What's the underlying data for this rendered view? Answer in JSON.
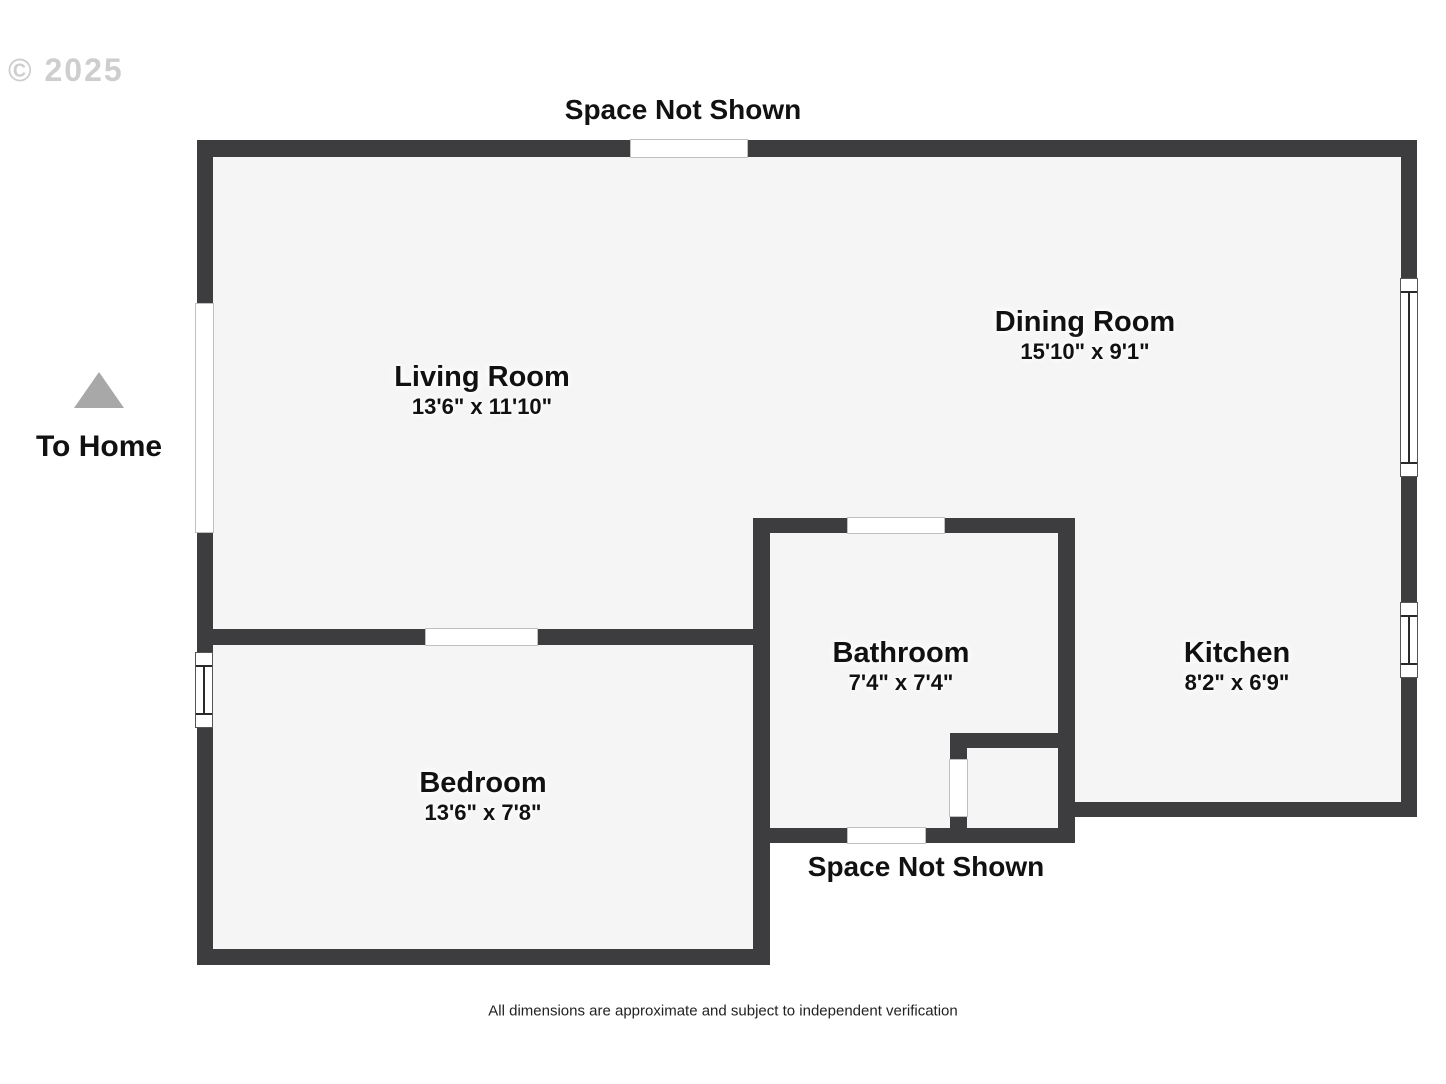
{
  "annotations": {
    "copyright": "© 2025",
    "space_not_shown_top": "Space Not Shown",
    "space_not_shown_bottom": "Space Not Shown",
    "to_home": "To Home",
    "footer": "All dimensions are approximate and subject to independent verification"
  },
  "rooms": [
    {
      "name": "Living Room",
      "dims": "13'6\" x 11'10\""
    },
    {
      "name": "Dining Room",
      "dims": "15'10\" x 9'1\""
    },
    {
      "name": "Bathroom",
      "dims": "7'4\" x 7'4\""
    },
    {
      "name": "Kitchen",
      "dims": "8'2\" x 6'9\""
    },
    {
      "name": "Bedroom",
      "dims": "13'6\" x 7'8\""
    }
  ],
  "colors": {
    "wall": "#3d3d40",
    "floor": "#f5f5f5",
    "opening_border": "#c0c0c0",
    "window_line": "#2a2a2a",
    "arrow": "#a8a8a8",
    "text": "#111111",
    "watermark": "#c3c3c3"
  },
  "geometry": {
    "floors": [
      {
        "x": 213,
        "y": 157,
        "w": 1189,
        "h": 472
      },
      {
        "x": 1075,
        "y": 157,
        "w": 327,
        "h": 645
      },
      {
        "x": 770,
        "y": 533,
        "w": 288,
        "h": 295
      },
      {
        "x": 967,
        "y": 748,
        "w": 91,
        "h": 80
      },
      {
        "x": 213,
        "y": 645,
        "w": 540,
        "h": 305
      }
    ],
    "walls": [
      {
        "x": 197,
        "y": 140,
        "w": 1220,
        "h": 17
      },
      {
        "x": 197,
        "y": 140,
        "w": 16,
        "h": 825
      },
      {
        "x": 1401,
        "y": 140,
        "w": 16,
        "h": 677
      },
      {
        "x": 197,
        "y": 629,
        "w": 573,
        "h": 16
      },
      {
        "x": 197,
        "y": 949,
        "w": 573,
        "h": 16
      },
      {
        "x": 753,
        "y": 518,
        "w": 17,
        "h": 447
      },
      {
        "x": 753,
        "y": 518,
        "w": 322,
        "h": 15
      },
      {
        "x": 1058,
        "y": 518,
        "w": 17,
        "h": 325
      },
      {
        "x": 950,
        "y": 733,
        "w": 125,
        "h": 15
      },
      {
        "x": 950,
        "y": 733,
        "w": 17,
        "h": 110
      },
      {
        "x": 753,
        "y": 828,
        "w": 322,
        "h": 15
      },
      {
        "x": 1058,
        "y": 802,
        "w": 359,
        "h": 15
      }
    ],
    "openings": [
      {
        "x": 630,
        "y": 139,
        "w": 118,
        "h": 19
      },
      {
        "x": 195,
        "y": 303,
        "w": 19,
        "h": 230
      },
      {
        "x": 425,
        "y": 628,
        "w": 113,
        "h": 18
      },
      {
        "x": 847,
        "y": 517,
        "w": 98,
        "h": 17
      },
      {
        "x": 847,
        "y": 827,
        "w": 79,
        "h": 17
      },
      {
        "x": 949,
        "y": 759,
        "w": 19,
        "h": 58
      }
    ],
    "windows": [
      {
        "x": 1400,
        "y": 278,
        "w": 18,
        "h": 199
      },
      {
        "x": 1400,
        "y": 602,
        "w": 18,
        "h": 76
      },
      {
        "x": 195,
        "y": 652,
        "w": 18,
        "h": 76
      }
    ]
  }
}
